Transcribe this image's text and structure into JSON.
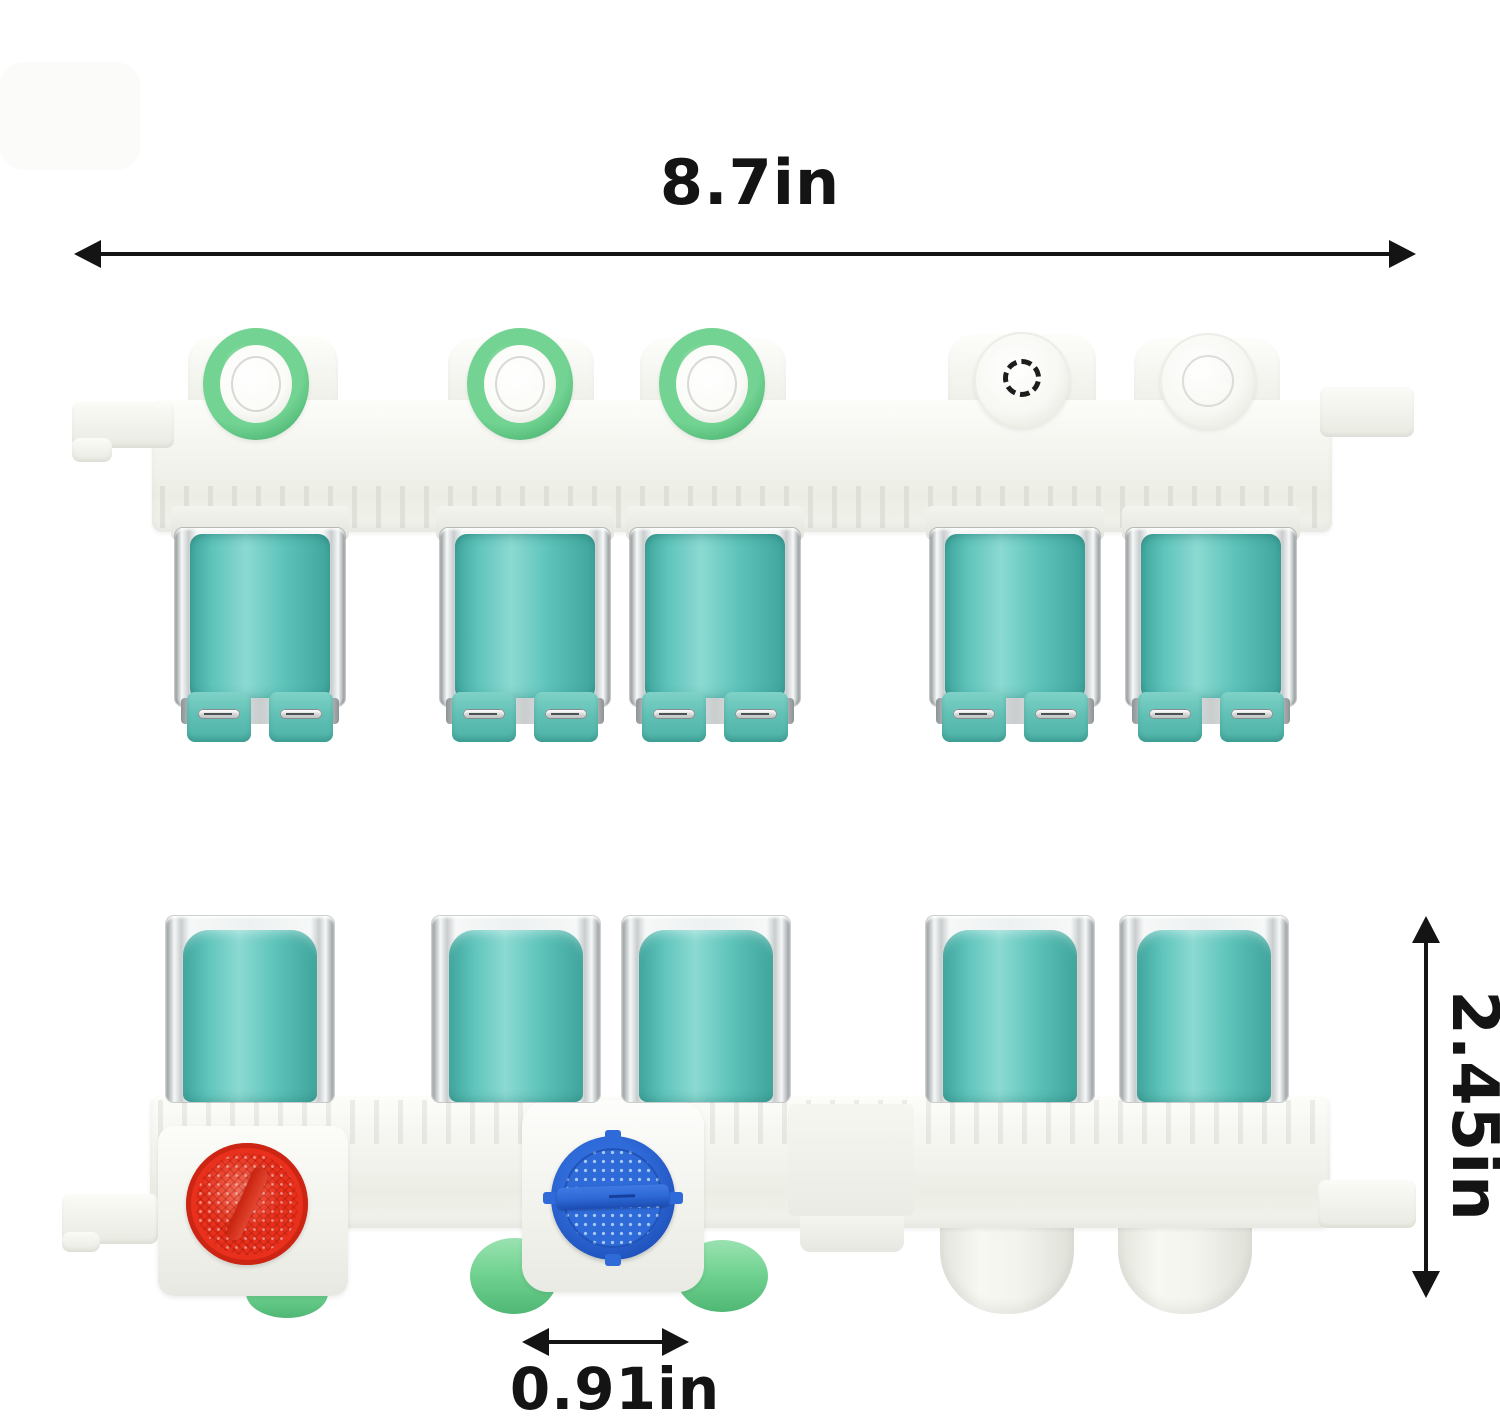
{
  "image": {
    "description": "Washing machine water inlet valve assembly shown from two angles with dimension annotations",
    "background": "#ffffff"
  },
  "annotations": {
    "width": {
      "label": "8.7in"
    },
    "height": {
      "label": "2.45in"
    },
    "port_spacing": {
      "label": "0.91in"
    }
  },
  "views": {
    "top_view": {
      "green_inlet_ports": 3,
      "white_ports": 2,
      "solenoid_coils": 5
    },
    "bottom_view": {
      "solenoid_coils": 5,
      "filter_screens": [
        "red",
        "blue"
      ],
      "green_outlets": 3,
      "white_outlet_domes": 2
    }
  },
  "colors": {
    "bg": "#ffffff",
    "ink": "#141414",
    "plastic": "#f8f8f4",
    "plastic_mid": "#eceee6",
    "plastic_deep": "#dfe0d8",
    "teal": "#5ec4bb",
    "teal_light": "#8bdad2",
    "teal_dark": "#3fa59c",
    "tab_teal": "#62c1b6",
    "chrome_light": "#f6f8f8",
    "chrome_mid": "#c9cdce",
    "chrome_dark": "#8e9496",
    "green": "#72d392",
    "green_dark": "#4fb774",
    "red": "#e8301c",
    "red_dark": "#b81f0e",
    "blue": "#2e6ad8",
    "blue_dark": "#1e4fb8",
    "blue_dot": "#a9c9f5",
    "silver": "#d7d9d9"
  }
}
